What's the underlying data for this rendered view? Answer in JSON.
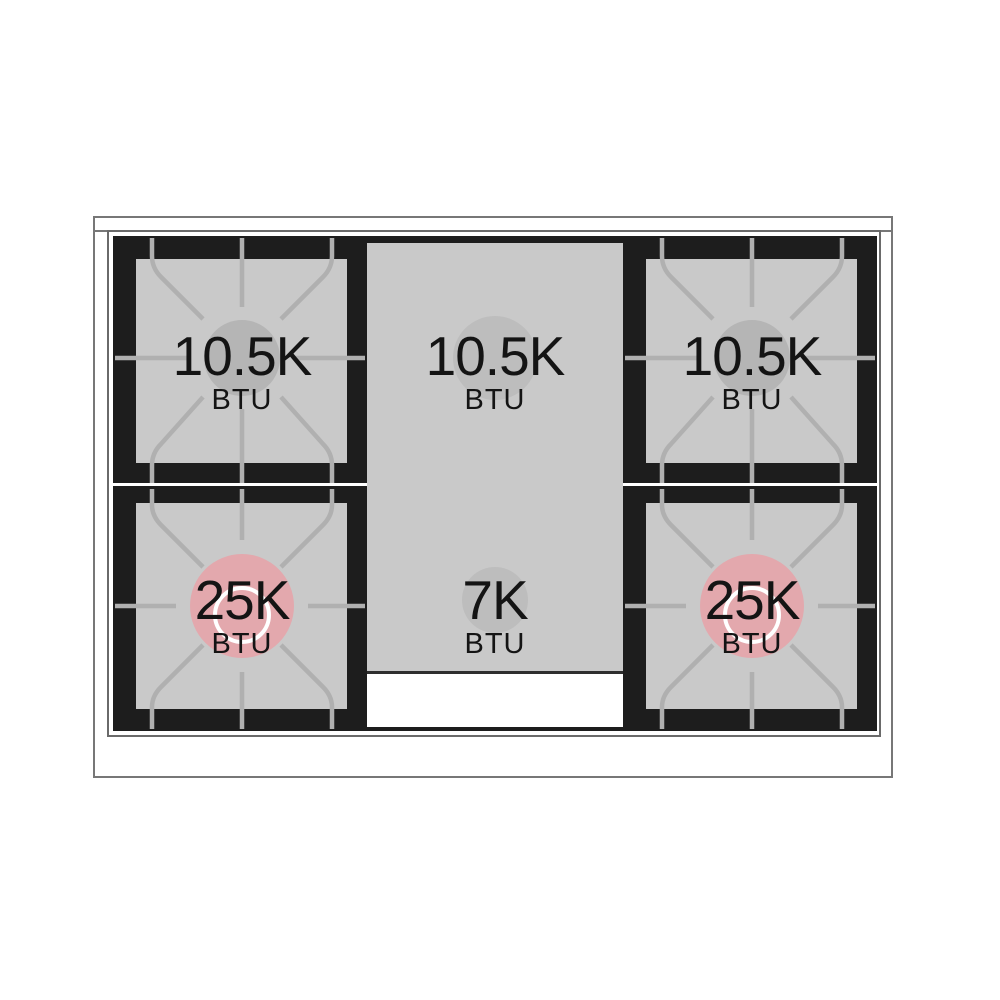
{
  "burners": [
    {
      "id": "top-left",
      "value": "10.5K",
      "unit": "BTU"
    },
    {
      "id": "top-center",
      "value": "10.5K",
      "unit": "BTU"
    },
    {
      "id": "top-right",
      "value": "10.5K",
      "unit": "BTU"
    },
    {
      "id": "bottom-left",
      "value": "25K",
      "unit": "BTU"
    },
    {
      "id": "bottom-center",
      "value": "7K",
      "unit": "BTU"
    },
    {
      "id": "bottom-right",
      "value": "25K",
      "unit": "BTU"
    }
  ],
  "colors": {
    "cooktop-black": "#1d1d1d",
    "panel-gray": "#c9c9c9",
    "burner-gray": "#b5b5b5",
    "griddle-circle-gray": "#bdbdbd",
    "burner-pink": "#e3a8ad",
    "grate-gray": "#b0b0b0",
    "frame-line": "#777777",
    "label-black": "#141414"
  }
}
